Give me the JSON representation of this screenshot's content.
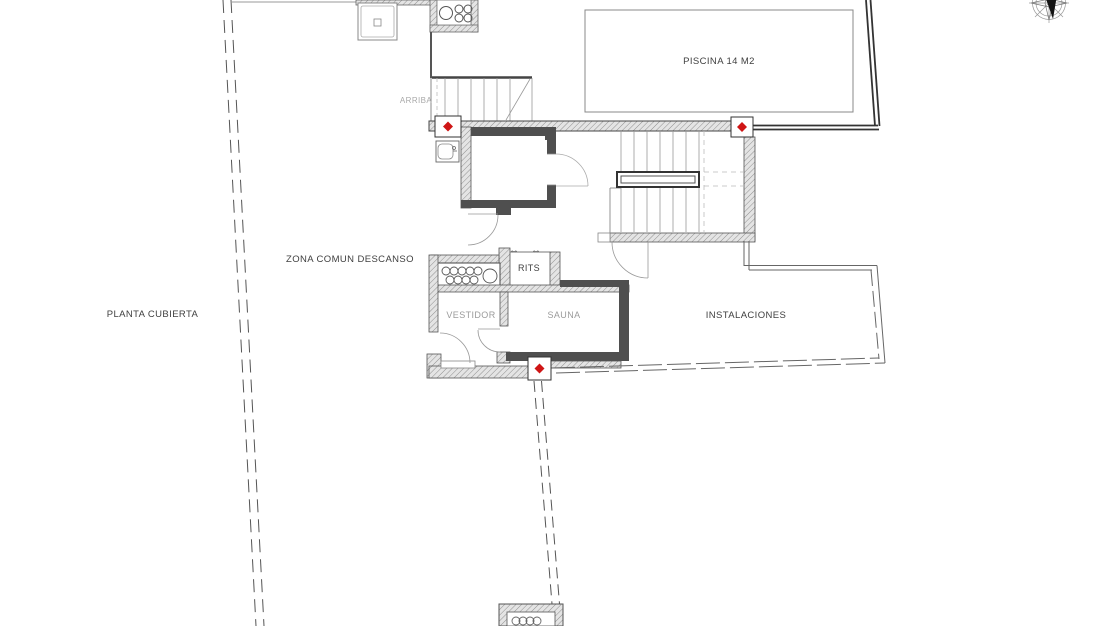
{
  "plan": {
    "title": "PLANTA CUBIERTA",
    "rooms": [
      {
        "id": "piscina",
        "label": "PISCINA 14 M2"
      },
      {
        "id": "zona_comun",
        "label": "ZONA COMUN DESCANSO"
      },
      {
        "id": "rits",
        "label": "RITS"
      },
      {
        "id": "vestidor",
        "label": "VESTIDOR"
      },
      {
        "id": "sauna",
        "label": "SAUNA"
      },
      {
        "id": "instalaciones",
        "label": "INSTALACIONES"
      }
    ],
    "annotations": {
      "floor_title": "PLANTA CUBIERTA",
      "stairs_direction": "ARRIBA",
      "vent_arrow": "↔"
    },
    "colors": {
      "marker_red": "#cf1515",
      "wall_dark": "#4f4f4f",
      "wall_hatch_bg": "#e4e4e4",
      "line_grey": "#999999"
    }
  }
}
